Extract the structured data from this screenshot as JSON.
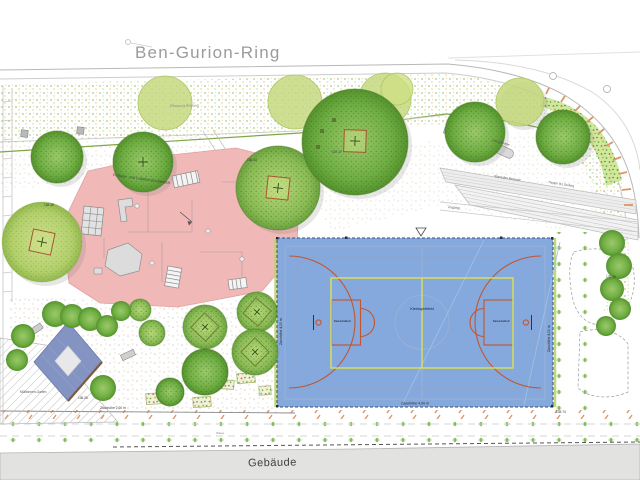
{
  "labels": {
    "street": "Ben-Gurion-Ring",
    "building": "Gebäude",
    "playground": "Parkour- und Calisthenics-Bereich",
    "court_center": "Kleinspielfeld",
    "hoop": "Basketballkorb",
    "fence_court": "Zaunhöhe 4,00 m",
    "fence_low": "Zaunhöhe 2,00 m",
    "zugang": "Zugang",
    "haengematte": "Hängematte",
    "treppe": "Treppe (11 Stufen)",
    "sitzstufen": "Sitzstufen Bestand",
    "muell": "Mülltonnen-Garten",
    "pflanzung": "Pflanzung Bestand",
    "wiese": "Wiese"
  },
  "elevations": [
    "136.38",
    "136.26",
    "136.43",
    "137.17",
    "135.74",
    "135.76"
  ],
  "colors": {
    "court_blue": "#86a9dd",
    "court_line_red": "#c2552f",
    "court_line_yellow": "#dde24e",
    "playground_pink": "#f1b8b8",
    "sand_blue": "#8494c2",
    "building_gray": "#e2e2e1",
    "tree_green": "#6fae43",
    "lawn_green": "#74b54a"
  }
}
